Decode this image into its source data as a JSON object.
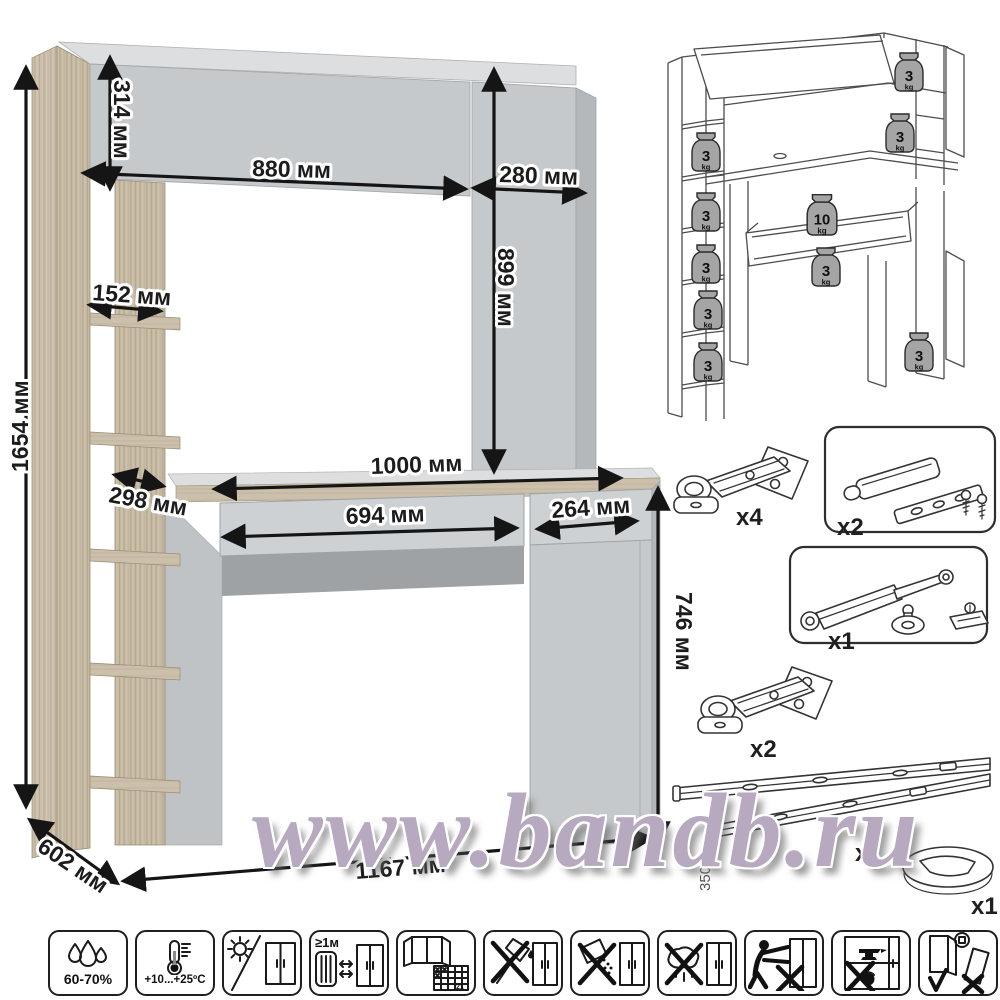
{
  "watermark": {
    "text": "www.bandb.ru",
    "color": "#b7a9bf"
  },
  "main": {
    "dims": {
      "total_height": "1654 мм",
      "hutch_height": "314 мм",
      "hutch_width": "880 мм",
      "side_cabinet_width": "280 мм",
      "opening_height": "899 мм",
      "shelf_width": "152 мм",
      "shelf_depth": "298 мм",
      "desktop_width": "1000 мм",
      "drawer_width": "694 мм",
      "door_width": "264 мм",
      "desk_height": "746 мм",
      "depth": "602 мм",
      "total_width": "1167 мм"
    },
    "colors": {
      "wood": "#c4b8a2",
      "panel_gray": "#c6c9cb",
      "panel_gray_light": "#dcdee0",
      "panel_gray_dark": "#9ea2a5"
    }
  },
  "load_diagram": {
    "weights": [
      {
        "value": "3",
        "unit": "kg",
        "location": "left-shelf-1"
      },
      {
        "value": "3",
        "unit": "kg",
        "location": "left-shelf-2"
      },
      {
        "value": "3",
        "unit": "kg",
        "location": "left-shelf-3"
      },
      {
        "value": "3",
        "unit": "kg",
        "location": "left-shelf-4"
      },
      {
        "value": "3",
        "unit": "kg",
        "location": "left-shelf-5"
      },
      {
        "value": "3",
        "unit": "kg",
        "location": "hutch-top-right"
      },
      {
        "value": "3",
        "unit": "kg",
        "location": "right-shelf"
      },
      {
        "value": "10",
        "unit": "kg",
        "location": "desktop"
      },
      {
        "value": "3",
        "unit": "kg",
        "location": "drawer"
      },
      {
        "value": "3",
        "unit": "kg",
        "location": "lower-cabinet"
      }
    ]
  },
  "hardware": {
    "items": [
      {
        "name": "concealed-hinge",
        "qty": "x4"
      },
      {
        "name": "push-to-open-latch",
        "qty": "x2"
      },
      {
        "name": "gas-lift",
        "qty": "x1"
      },
      {
        "name": "concealed-hinge",
        "qty": "x2"
      },
      {
        "name": "drawer-slides",
        "qty": "x1",
        "length": "350mm"
      },
      {
        "name": "cable-grommet",
        "qty": "x1"
      }
    ]
  },
  "care": {
    "humidity": "60-70%",
    "temperature": "+10...+25ºC",
    "heat_distance": "≥1м",
    "calendar_day": "21",
    "icons": [
      {
        "name": "humidity-range"
      },
      {
        "name": "temperature-range"
      },
      {
        "name": "avoid-direct-sunlight"
      },
      {
        "name": "keep-1m-from-heat"
      },
      {
        "name": "ventilate-room"
      },
      {
        "name": "no-sharp-objects"
      },
      {
        "name": "no-abrasive-cleaners"
      },
      {
        "name": "no-wet-cloth"
      },
      {
        "name": "do-not-drag"
      },
      {
        "name": "do-not-overload"
      },
      {
        "name": "transport-upright"
      }
    ]
  }
}
